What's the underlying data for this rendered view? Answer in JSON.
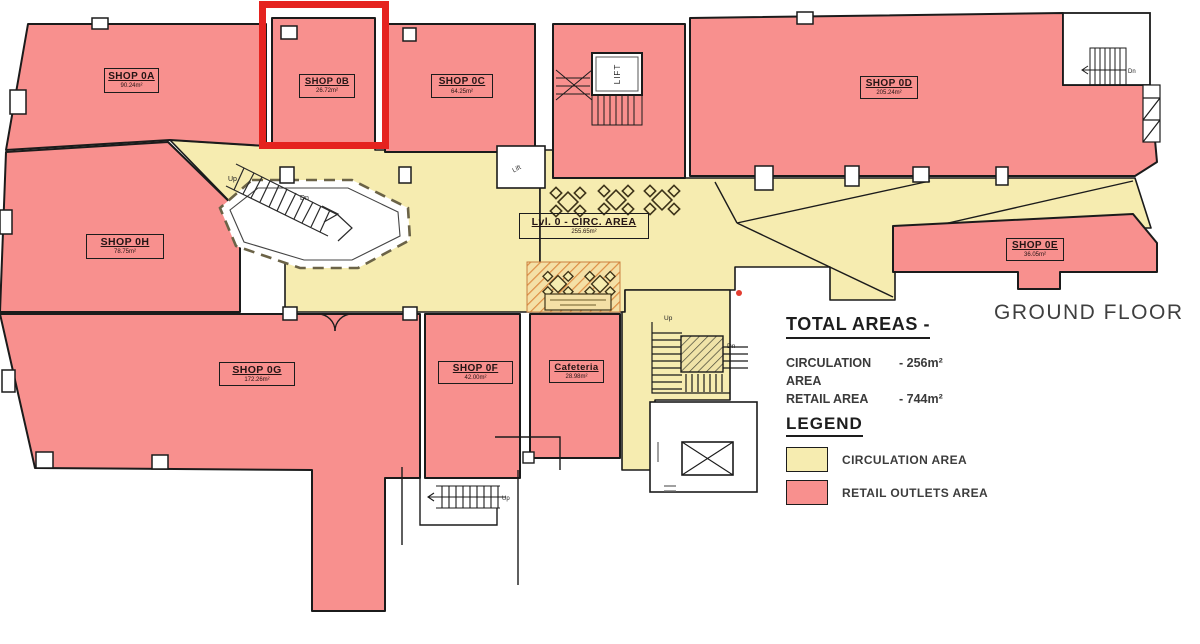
{
  "floor_label": "GROUND FLOOR",
  "shops": {
    "a": {
      "name": "SHOP 0A",
      "area": "90.24m²"
    },
    "b": {
      "name": "SHOP 0B",
      "area": "26.72m²"
    },
    "c": {
      "name": "SHOP 0C",
      "area": "64.25m²"
    },
    "d": {
      "name": "SHOP 0D",
      "area": "205.24m²"
    },
    "e": {
      "name": "SHOP 0E",
      "area": "36.05m²"
    },
    "f": {
      "name": "SHOP 0F",
      "area": "42.00m²"
    },
    "g": {
      "name": "SHOP 0G",
      "area": "172.26m²"
    },
    "h": {
      "name": "SHOP 0H",
      "area": "78.75m²"
    },
    "cafeteria": {
      "name": "Cafeteria",
      "area": "28.98m²"
    }
  },
  "circulation": {
    "name": "Lvl. 0 - CIRC. AREA",
    "area": "255.65m²"
  },
  "totals": {
    "heading": "TOTAL AREAS -",
    "rows": [
      {
        "label": "CIRCULATION AREA",
        "value": "- 256m²"
      },
      {
        "label": "RETAIL AREA",
        "value": "- 744m²"
      }
    ]
  },
  "legend": {
    "heading": "LEGEND",
    "items": [
      {
        "label": "CIRCULATION AREA",
        "color": "#F6ECB0"
      },
      {
        "label": "RETAIL OUTLETS AREA",
        "color": "#F8908E"
      }
    ]
  },
  "markers": {
    "lift": "LIFT",
    "lift_small": "Lift",
    "up": "Up",
    "dn": "Dn"
  },
  "highlight": {
    "target": "SHOP 0B",
    "color": "#E5231F"
  },
  "colors": {
    "circulation": "#F6ECB0",
    "retail": "#F8908E",
    "wall": "#1b1b1b",
    "highlight": "#E5231F"
  }
}
